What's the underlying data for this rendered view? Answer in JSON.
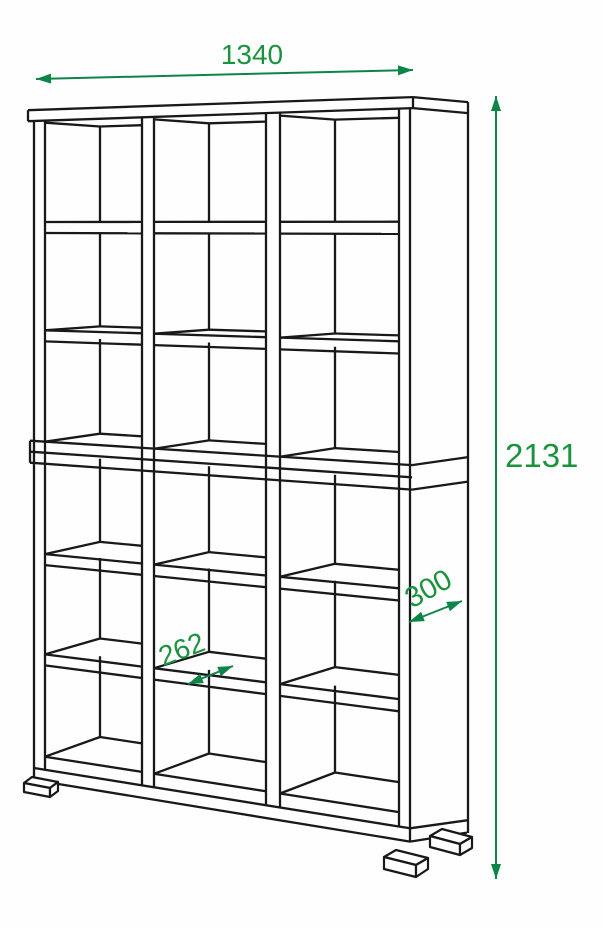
{
  "figure": {
    "type": "dimensional line drawing",
    "subject": "open cube shelving unit, 3 columns by 6 rows of cells, two stacked sections on feet",
    "dimensions": {
      "width": "1340",
      "height": "2131",
      "depth": "300",
      "cell_width": "262"
    }
  },
  "colors": {
    "outline": "#191919",
    "dimension_line": "#0d8547",
    "dimension_text": "#1b933e",
    "background": "#fefefe"
  }
}
